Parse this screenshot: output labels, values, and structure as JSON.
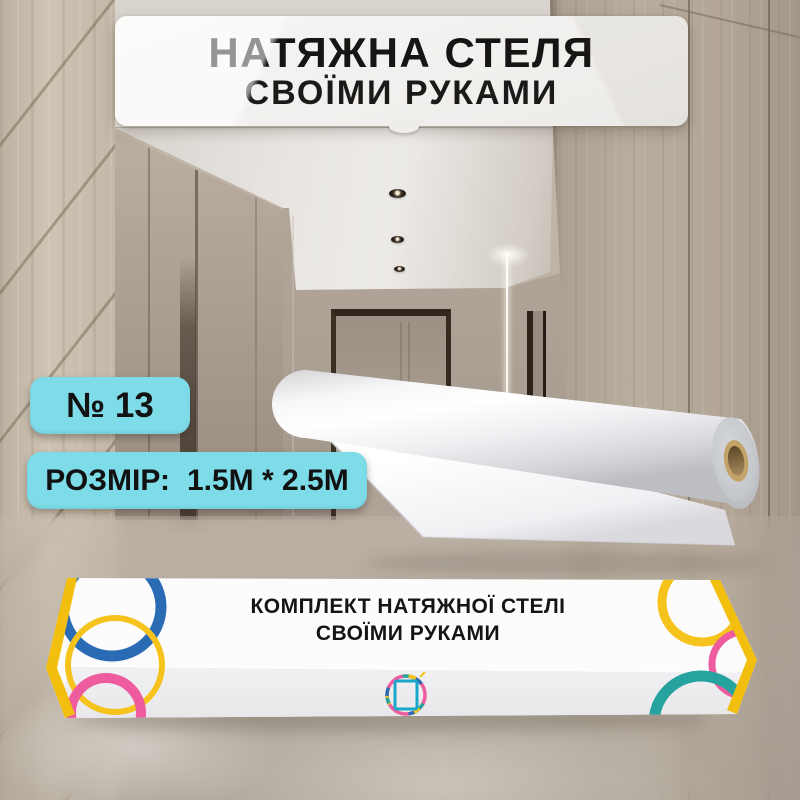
{
  "banner": {
    "line1": "НАТЯЖНА СТЕЛЯ",
    "line2": "СВОЇМИ РУКАМИ"
  },
  "badges": {
    "number": "№ 13",
    "size_label": "РОЗМІР:",
    "size_value": "1.5М * 2.5М"
  },
  "box": {
    "line1": "КОМПЛЕКТ НАТЯЖНОЇ СТЕЛІ",
    "line2": "СВОЇМИ РУКАМИ"
  },
  "colors": {
    "badge_cyan": "#7edce9",
    "cap_yellow": "#f2bf0e",
    "ring_blue": "#2a6cb4",
    "ring_pink": "#ee5c9f",
    "ring_yellow": "#f5c31b",
    "ring_teal": "#27a39f",
    "logo_teal": "#1aa7c9"
  }
}
